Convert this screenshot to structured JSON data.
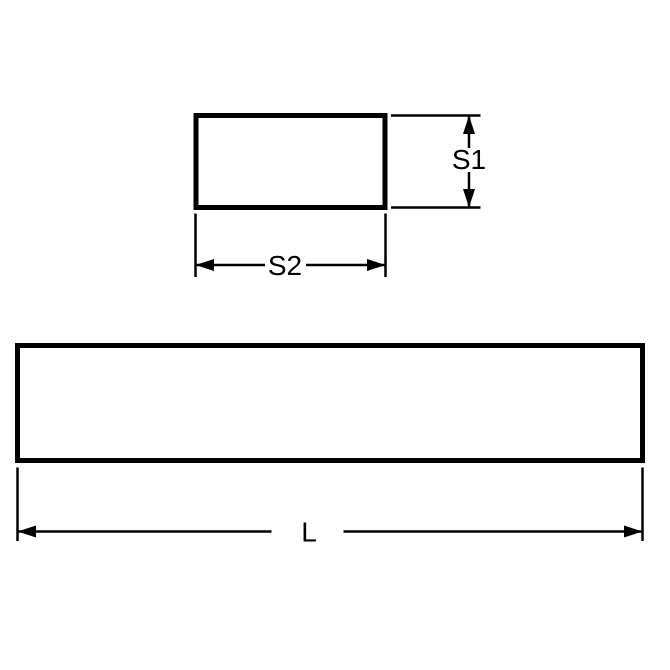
{
  "figure": {
    "colors": {
      "line": "#000000",
      "background": "#ffffff"
    },
    "cross_section": {
      "height_label": "S1",
      "width_label": "S2"
    },
    "bar": {
      "length_label": "L"
    }
  }
}
